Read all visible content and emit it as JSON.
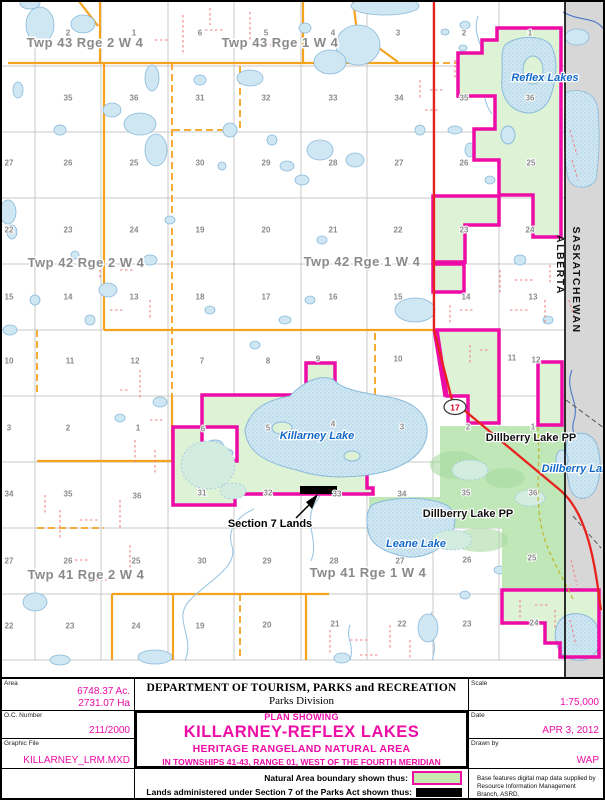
{
  "map": {
    "colors": {
      "magenta": "#ee0ca6",
      "natural_green": "#def2d6",
      "pp_green": "#bfe7b7",
      "pp_green_dark": "#a8dba0",
      "orange": "#f5a21f",
      "red_road": "#e8231e",
      "trail_red": "#ef8282",
      "olive_trail": "#c3b52d",
      "grid_gray": "#c9c9c9",
      "sask_gray": "#d7d7d7",
      "lake_fill": "#cfe6f3",
      "lake_stroke": "#8abadb",
      "stream_blue": "#9cc7e3",
      "sask_stream": "#4a78c8",
      "label_gray": "#8a8a8a",
      "water_label_blue": "#1068c8",
      "shield_red": "#d6001c"
    },
    "township_labels": [
      {
        "text": "Twp 43 Rge 2 W 4",
        "x": 85,
        "y": 47
      },
      {
        "text": "Twp 43 Rge 1 W 4",
        "x": 280,
        "y": 47
      },
      {
        "text": "Twp 42 Rge 2 W 4",
        "x": 86,
        "y": 267
      },
      {
        "text": "Twp 42 Rge 1 W 4",
        "x": 362,
        "y": 266
      },
      {
        "text": "Twp 41 Rge 2 W 4",
        "x": 86,
        "y": 579
      },
      {
        "text": "Twp 41 Rge 1 W 4",
        "x": 368,
        "y": 577
      }
    ],
    "water_labels": [
      {
        "text": "Reflex Lakes",
        "x": 545,
        "y": 81
      },
      {
        "text": "Killarney Lake",
        "x": 317,
        "y": 439
      },
      {
        "text": "Dillberry Lake",
        "x": 578,
        "y": 472
      },
      {
        "text": "Leane Lake",
        "x": 416,
        "y": 547
      }
    ],
    "park_labels": [
      {
        "text": "Dillberry Lake PP",
        "x": 531,
        "y": 441
      },
      {
        "text": "Dillberry Lake PP",
        "x": 468,
        "y": 517
      }
    ],
    "annotation_label": {
      "text": "Section 7 Lands",
      "x": 270,
      "y": 527
    },
    "highway_shield": {
      "text": "17",
      "x": 455,
      "y": 407
    },
    "border_labels": {
      "alberta": "ALBERTA",
      "saskatchewan": "SASKATCHEWAN"
    },
    "section_numbers": [
      [
        68,
        33,
        "2"
      ],
      [
        134,
        33,
        "1"
      ],
      [
        200,
        33,
        "6"
      ],
      [
        266,
        33,
        "5"
      ],
      [
        333,
        33,
        "4"
      ],
      [
        398,
        33,
        "3"
      ],
      [
        464,
        33,
        "2"
      ],
      [
        530,
        33,
        "1"
      ],
      [
        68,
        98,
        "35"
      ],
      [
        134,
        98,
        "36"
      ],
      [
        200,
        98,
        "31"
      ],
      [
        266,
        98,
        "32"
      ],
      [
        333,
        98,
        "33"
      ],
      [
        399,
        98,
        "34"
      ],
      [
        464,
        98,
        "35"
      ],
      [
        530,
        98,
        "36"
      ],
      [
        9,
        163,
        "27"
      ],
      [
        68,
        163,
        "26"
      ],
      [
        134,
        163,
        "25"
      ],
      [
        200,
        163,
        "30"
      ],
      [
        266,
        163,
        "29"
      ],
      [
        333,
        163,
        "28"
      ],
      [
        399,
        163,
        "27"
      ],
      [
        464,
        163,
        "26"
      ],
      [
        531,
        163,
        "25"
      ],
      [
        9,
        230,
        "22"
      ],
      [
        68,
        230,
        "23"
      ],
      [
        134,
        230,
        "24"
      ],
      [
        200,
        230,
        "19"
      ],
      [
        266,
        230,
        "20"
      ],
      [
        333,
        230,
        "21"
      ],
      [
        398,
        230,
        "22"
      ],
      [
        464,
        230,
        "23"
      ],
      [
        530,
        230,
        "24"
      ],
      [
        9,
        297,
        "15"
      ],
      [
        68,
        297,
        "14"
      ],
      [
        134,
        297,
        "13"
      ],
      [
        200,
        297,
        "18"
      ],
      [
        266,
        297,
        "17"
      ],
      [
        333,
        297,
        "16"
      ],
      [
        398,
        297,
        "15"
      ],
      [
        466,
        297,
        "14"
      ],
      [
        533,
        297,
        "13"
      ],
      [
        9,
        361,
        "10"
      ],
      [
        70,
        361,
        "11"
      ],
      [
        135,
        361,
        "12"
      ],
      [
        202,
        361,
        "7"
      ],
      [
        268,
        361,
        "8"
      ],
      [
        318,
        359,
        "9"
      ],
      [
        398,
        359,
        "10"
      ],
      [
        512,
        358,
        "11"
      ],
      [
        536,
        360,
        "12"
      ],
      [
        9,
        428,
        "3"
      ],
      [
        68,
        428,
        "2"
      ],
      [
        138,
        428,
        "1"
      ],
      [
        203,
        429,
        "6"
      ],
      [
        268,
        428,
        "5"
      ],
      [
        333,
        424,
        "4"
      ],
      [
        402,
        427,
        "3"
      ],
      [
        468,
        427,
        "2"
      ],
      [
        533,
        427,
        "1"
      ],
      [
        9,
        494,
        "34"
      ],
      [
        68,
        494,
        "35"
      ],
      [
        137,
        496,
        "36"
      ],
      [
        202,
        493,
        "31"
      ],
      [
        268,
        493,
        "32"
      ],
      [
        337,
        494,
        "33"
      ],
      [
        402,
        494,
        "34"
      ],
      [
        466,
        493,
        "35"
      ],
      [
        533,
        493,
        "36"
      ],
      [
        9,
        561,
        "27"
      ],
      [
        68,
        561,
        "26"
      ],
      [
        136,
        561,
        "25"
      ],
      [
        202,
        561,
        "30"
      ],
      [
        267,
        561,
        "29"
      ],
      [
        334,
        561,
        "28"
      ],
      [
        400,
        561,
        "27"
      ],
      [
        467,
        560,
        "26"
      ],
      [
        532,
        558,
        "25"
      ],
      [
        9,
        626,
        "22"
      ],
      [
        70,
        626,
        "23"
      ],
      [
        136,
        626,
        "24"
      ],
      [
        200,
        626,
        "19"
      ],
      [
        267,
        625,
        "20"
      ],
      [
        335,
        624,
        "21"
      ],
      [
        402,
        624,
        "22"
      ],
      [
        467,
        624,
        "23"
      ],
      [
        534,
        623,
        "24"
      ]
    ]
  },
  "title_block": {
    "area_label": "Area",
    "area_acres": "6748.37 Ac.",
    "area_ha": "2731.07 Ha",
    "oc_label": "O.C. Number",
    "oc_value": "211/2000",
    "file_label": "Graphic File",
    "file_value": "KILLARNEY_LRM.MXD",
    "dept_line1": "DEPARTMENT OF TOURISM, PARKS and RECREATION",
    "dept_line2": "Parks Division",
    "plan_showing": "PLAN SHOWING",
    "plan_title": "KILLARNEY-REFLEX LAKES",
    "plan_subtitle": "HERITAGE RANGELAND NATURAL AREA",
    "plan_desc": "IN TOWNSHIPS 41-43, RANGE 01, WEST OF THE FOURTH MERIDIAN",
    "legend_natural": "Natural Area boundary shown thus:",
    "legend_section7": "Lands administered under Section 7 of the Parks Act shown thus:",
    "scale_label": "Scale",
    "scale_value": "1:75,000",
    "date_label": "Date",
    "date_value": "APR 3, 2012",
    "drawn_label": "Drawn by",
    "drawn_value": "WAP",
    "credit": "Base features digital map data supplied by Resource Information Management Branch, ASRD."
  }
}
